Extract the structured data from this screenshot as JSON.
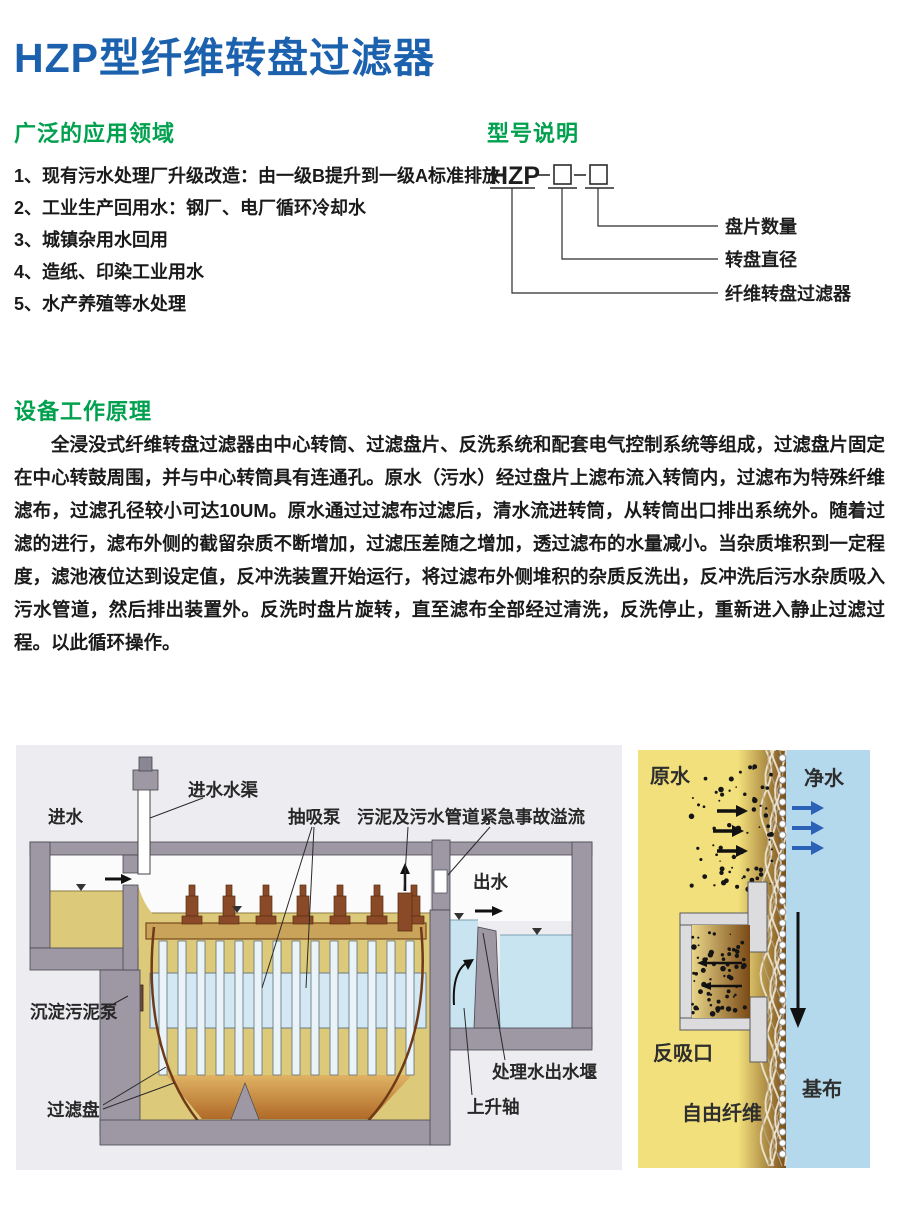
{
  "title": "HZP型纤维转盘过滤器",
  "colors": {
    "title_blue": "#1b61ae",
    "heading_green": "#00a14e"
  },
  "applications": {
    "heading": "广泛的应用领域",
    "items": [
      "1、现有污水处理厂升级改造：由一级B提升到一级A标准排放",
      "2、工业生产回用水：钢厂、电厂循环冷却水",
      "3、城镇杂用水回用",
      "4、造纸、印染工业用水",
      "5、水产养殖等水处理"
    ]
  },
  "model": {
    "heading": "型号说明",
    "code": "HZP",
    "callouts": [
      "盘片数量",
      "转盘直径",
      "纤维转盘过滤器"
    ]
  },
  "principle": {
    "heading": "设备工作原理",
    "text": "全浸没式纤维转盘过滤器由中心转筒、过滤盘片、反洗系统和配套电气控制系统等组成，过滤盘片固定在中心转鼓周围，并与中心转筒具有连通孔。原水（污水）经过盘片上滤布流入转筒内，过滤布为特殊纤维滤布，过滤孔径较小可达10UM。原水通过过滤布过滤后，清水流进转筒，从转筒出口排出系统外。随着过滤的进行，滤布外侧的截留杂质不断增加，过滤压差随之增加，透过滤布的水量减小。当杂质堆积到一定程度，滤池液位达到设定值，反冲洗装置开始运行，将过滤布外侧堆积的杂质反洗出，反冲洗后污水杂质吸入污水管道，然后排出装置外。反洗时盘片旋转，直至滤布全部经过清洗，反洗停止，重新进入静止过滤过程。以此循环操作。"
  },
  "fig_left": {
    "labels": {
      "inlet": "进水",
      "inlet_channel": "进水水渠",
      "suction_pump": "抽吸泵",
      "sludge_pipe": "污泥及污水管道",
      "emergency_overflow": "紧急事故溢流",
      "outlet": "出水",
      "settled_sludge_pump": "沉淀污泥泵",
      "filter_disc": "过滤盘",
      "rising_shaft": "上升轴",
      "outlet_weir": "处理水出水堰"
    }
  },
  "fig_right": {
    "labels": {
      "raw_water": "原水",
      "clean_water": "净水",
      "back_suction_port": "反吸口",
      "base_cloth": "基布",
      "free_fiber": "自由纤维"
    }
  }
}
